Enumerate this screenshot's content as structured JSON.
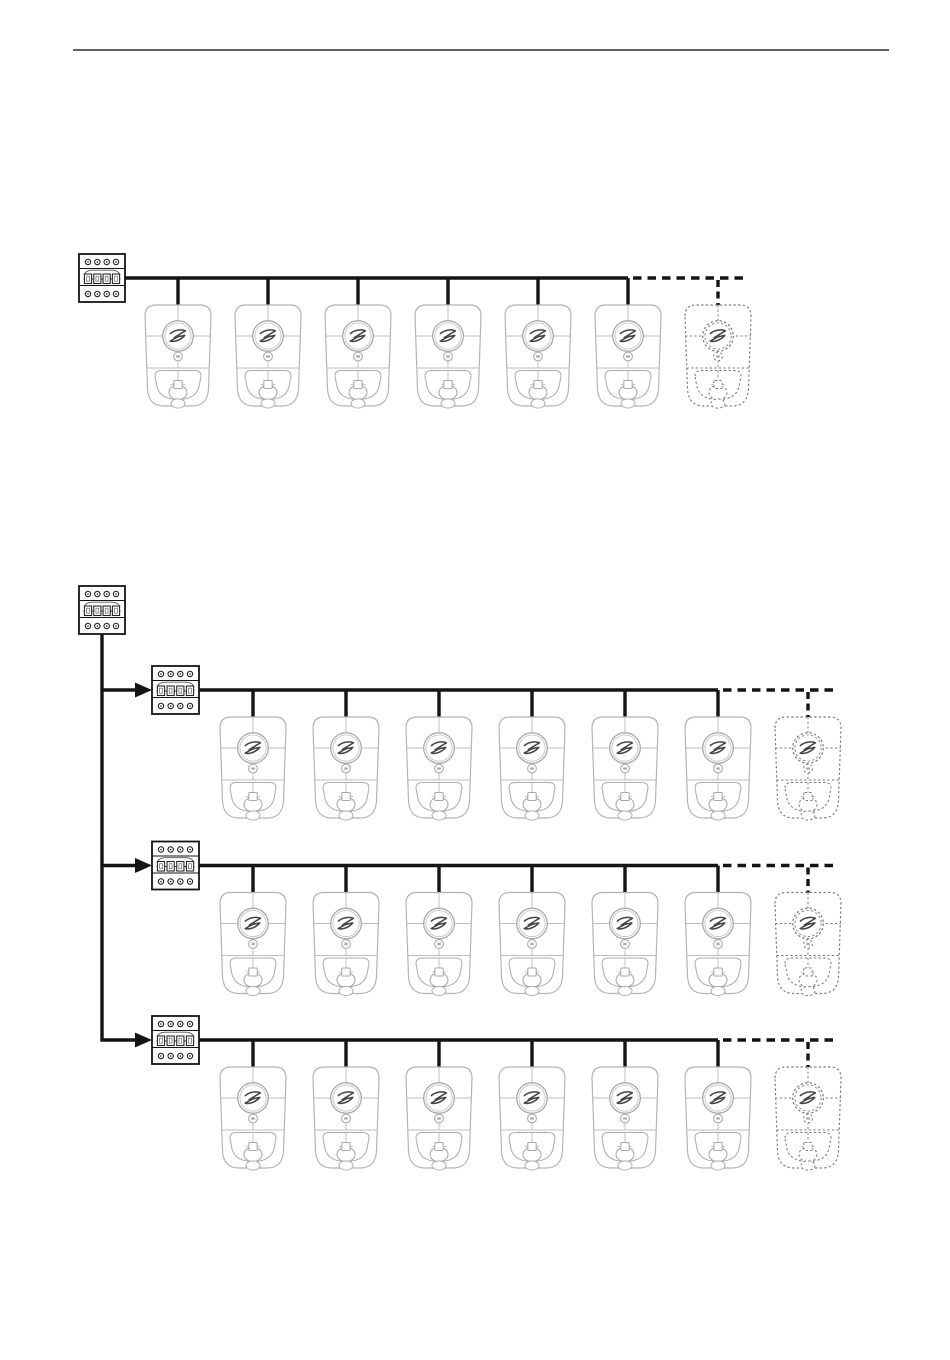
{
  "document": {
    "kind": "installation-manual-wiring-diagram-page",
    "header_rule": {
      "present": true
    }
  },
  "icons": {
    "breaker_icon": "circuit-breaker-4pole-icon",
    "charger_icon": "zaptec-pro-ev-charger-icon",
    "expansion_charger_icon": "future-ev-charger-dotted-icon",
    "logo_icon": "z-logo-icon",
    "arrow_icon": "branch-feed-arrow-icon"
  },
  "diagram": {
    "figure1": {
      "supply_breakers": 1,
      "chargers": 6,
      "expansion_chargers": 1
    },
    "figure2": {
      "main_breakers": 1,
      "branches": [
        {
          "breakers": 1,
          "chargers": 6,
          "expansion_chargers": 1
        },
        {
          "breakers": 1,
          "chargers": 6,
          "expansion_chargers": 1
        },
        {
          "breakers": 1,
          "chargers": 6,
          "expansion_chargers": 1
        }
      ]
    }
  },
  "colors": {
    "background": "#ffffff",
    "header_rule": "#2b2b2b",
    "wire": "#141414",
    "breaker_stroke": "#141414",
    "charger_body_stroke": "#b2b2b2",
    "charger_inner_stroke": "#bdbdbd",
    "charger_ring_stroke": "#a5a5a5",
    "logo_stroke": "#454545",
    "expansion_stroke": "#7a7a7a"
  }
}
